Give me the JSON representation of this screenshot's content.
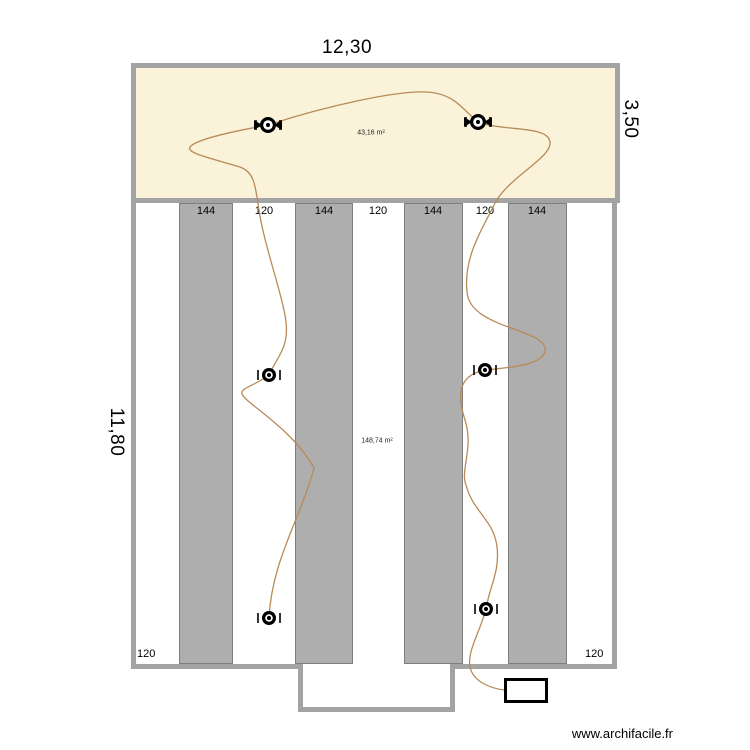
{
  "watermark": "www.archifacile.fr",
  "colors": {
    "wall": "#a3a3a3",
    "room_top_fill": "#faf3da",
    "stripe_fill": "#aeaeae",
    "stripe_border": "#7e7e7e",
    "cable": "#b98a58",
    "fixture": "#000000",
    "text": "#000000"
  },
  "dimensions": {
    "top_width": "12,30",
    "right_height": "3,50",
    "left_height": "11,80"
  },
  "rooms": [
    {
      "id": "room-top",
      "area_label": "43,16 m²"
    },
    {
      "id": "room-bottom",
      "area_label": "148,74 m²"
    }
  ],
  "measurements": {
    "band_labels": [
      "144",
      "120",
      "144",
      "120",
      "144",
      "120",
      "144"
    ],
    "band_centers_x": [
      206,
      264,
      324,
      378,
      433,
      485,
      537
    ],
    "bottom_left": "120",
    "bottom_right": "120"
  },
  "fixtures": [
    {
      "x": 268,
      "y": 125,
      "style": "winged"
    },
    {
      "x": 478,
      "y": 122,
      "style": "winged"
    },
    {
      "x": 269,
      "y": 375,
      "style": "plain"
    },
    {
      "x": 485,
      "y": 370,
      "style": "plain"
    },
    {
      "x": 269,
      "y": 618,
      "style": "plain"
    },
    {
      "x": 486,
      "y": 609,
      "style": "plain"
    }
  ],
  "cables": [
    {
      "name": "cable-left-run",
      "path": "M 268 125 C 235 131 196 139 190 147 C 186 153 210 158 240 167 C 254 172 255 185 258 203 C 262 240 283 295 286 322 C 289 348 277 357 269 375 C 256 385 240 388 242 394 C 245 403 292 428 314 468 C 300 520 272 560 269 618"
    },
    {
      "name": "cable-right-run",
      "path": "M 268 125 C 320 108 405 87 435 93 C 457 97 464 111 478 122 C 502 131 543 126 549 139 C 558 155 510 175 495 203 C 485 225 463 255 467 292 C 470 330 550 328 545 352 C 540 366 505 368 485 370 C 460 375 456 392 465 420 C 474 448 460 470 466 485 C 473 512 494 520 497 547 C 500 572 489 588 486 609 C 480 632 467 651 470 667 C 473 681 489 688 504 690"
    }
  ]
}
